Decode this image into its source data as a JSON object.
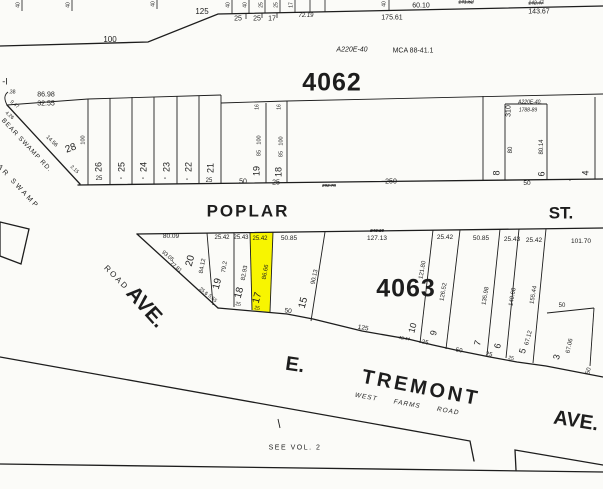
{
  "colors": {
    "paper": "#fbfbf8",
    "ink": "#1d1d1d",
    "highlight": "#f8f500"
  },
  "map": {
    "blocks": [
      "4062",
      "4063"
    ],
    "streets": [
      "POPLAR ST.",
      "E. TREMONT AVE.",
      "WEST FARMS ROAD",
      "BEAR SWAMP RD.",
      "AVE.",
      "ROAD"
    ],
    "notes": [
      "SEE VOL. 2",
      "MCA 88-41.1",
      "A220E-40",
      "A220E-40, 1788-89"
    ],
    "highlighted_lot": {
      "block": "4063",
      "lot": "17",
      "frontage": "25.42",
      "depth": "86.66"
    },
    "labels": [
      {
        "n": "dim-100",
        "t": "100",
        "x": 110,
        "y": 40,
        "s": 8
      },
      {
        "n": "dim-125",
        "t": "125",
        "x": 202,
        "y": 12,
        "s": 8
      },
      {
        "n": "dim-25",
        "t": "25",
        "x": 238,
        "y": 19,
        "s": 7
      },
      {
        "n": "dim-25",
        "t": "25",
        "x": 257,
        "y": 19,
        "s": 7
      },
      {
        "n": "dim-17",
        "t": "17",
        "x": 272,
        "y": 19,
        "s": 7
      },
      {
        "n": "dim-72-19",
        "t": "72.19",
        "x": 306,
        "y": 16,
        "s": 6,
        "i": 1
      },
      {
        "n": "dim-175-61",
        "t": "175.61",
        "x": 392,
        "y": 18,
        "s": 7
      },
      {
        "n": "dim-60-10",
        "t": "60.10",
        "x": 421,
        "y": 6,
        "s": 7
      },
      {
        "n": "dim-141-52",
        "t": "141.52",
        "x": 466,
        "y": 3,
        "s": 5,
        "i": 1,
        "k": 1
      },
      {
        "n": "dim-142-47",
        "t": "142.47",
        "x": 536,
        "y": 4,
        "s": 5,
        "i": 1,
        "k": 1
      },
      {
        "n": "dim-143-67",
        "t": "143.67",
        "x": 539,
        "y": 12,
        "s": 7
      },
      {
        "n": "stub-dim",
        "t": "40",
        "x": 19,
        "y": 5,
        "s": 5,
        "r": -90
      },
      {
        "n": "stub-dim",
        "t": "40",
        "x": 69,
        "y": 5,
        "s": 5,
        "r": -90
      },
      {
        "n": "stub-dim",
        "t": "40",
        "x": 154,
        "y": 4,
        "s": 5,
        "r": -90
      },
      {
        "n": "stub-dim",
        "t": "40",
        "x": 229,
        "y": 5,
        "s": 5,
        "r": -90
      },
      {
        "n": "stub-dim",
        "t": "40",
        "x": 246,
        "y": 5,
        "s": 5,
        "r": -90
      },
      {
        "n": "stub-dim",
        "t": "25",
        "x": 262,
        "y": 5,
        "s": 5,
        "r": -90
      },
      {
        "n": "stub-dim",
        "t": "25",
        "x": 277,
        "y": 5,
        "s": 5,
        "r": -90
      },
      {
        "n": "stub-dim",
        "t": "17",
        "x": 292,
        "y": 5,
        "s": 5,
        "r": -90
      },
      {
        "n": "stub-dim",
        "t": "40",
        "x": 385,
        "y": 4,
        "s": 5,
        "r": -90
      },
      {
        "n": "annotation-a220e",
        "t": "A220E-40",
        "x": 352,
        "y": 50,
        "s": 7,
        "i": 1
      },
      {
        "n": "annotation-mca",
        "t": "MCA 88-41.1",
        "x": 413,
        "y": 51,
        "s": 7
      },
      {
        "n": "block-4062-label",
        "t": "4062",
        "x": 332,
        "y": 83,
        "s": 25,
        "b": 1,
        "sp": 1
      },
      {
        "n": "label-parcel-edge",
        "t": "-I",
        "x": 5,
        "y": 82,
        "s": 9
      },
      {
        "n": "dim-38",
        "t": ".38",
        "x": 12,
        "y": 93,
        "s": 5
      },
      {
        "n": "dim-9-47",
        "t": "9.47",
        "x": 14,
        "y": 105,
        "s": 5,
        "r": 40
      },
      {
        "n": "dim-4-26",
        "t": "4.26",
        "x": 9,
        "y": 116,
        "s": 5,
        "r": 40
      },
      {
        "n": "dim-86-98",
        "t": "86.98",
        "x": 46,
        "y": 95,
        "s": 7
      },
      {
        "n": "dim-32-55",
        "t": "32.55",
        "x": 46,
        "y": 104,
        "s": 7
      },
      {
        "n": "street-bear-swamp-rd",
        "t": "BEAR SWAMP RD.",
        "x": 26,
        "y": 146,
        "s": 6.5,
        "r": 47,
        "sp": 1
      },
      {
        "n": "dim-14-56",
        "t": "14.56",
        "x": 51,
        "y": 142,
        "s": 5.5,
        "r": 44
      },
      {
        "n": "label-ar-swamp",
        "t": "AR SWAMP",
        "x": 18,
        "y": 187,
        "s": 7,
        "r": 47,
        "sp": 2.5
      },
      {
        "n": "lot-28-number",
        "t": "28",
        "x": 71,
        "y": 149,
        "s": 10,
        "r": -20
      },
      {
        "n": "dim-2-15",
        "t": "2.15",
        "x": 74,
        "y": 170,
        "s": 5,
        "r": 44
      },
      {
        "n": "dim-100v",
        "t": "100",
        "x": 84,
        "y": 140,
        "s": 5.5,
        "r": -90
      },
      {
        "n": "lot-26-number",
        "t": "26",
        "x": 99,
        "y": 167,
        "s": 9,
        "r": -90
      },
      {
        "n": "lot-25-number",
        "t": "25",
        "x": 122,
        "y": 167,
        "s": 9,
        "r": -90
      },
      {
        "n": "lot-24-number",
        "t": "24",
        "x": 144,
        "y": 167,
        "s": 9,
        "r": -90
      },
      {
        "n": "lot-23-number",
        "t": "23",
        "x": 167,
        "y": 167,
        "s": 9,
        "r": -90
      },
      {
        "n": "lot-22-number",
        "t": "22",
        "x": 189,
        "y": 167,
        "s": 9,
        "r": -90
      },
      {
        "n": "lot-21-number",
        "t": "21",
        "x": 211,
        "y": 168,
        "s": 9,
        "r": -90
      },
      {
        "n": "dim-frontage",
        "t": "25",
        "x": 99,
        "y": 179,
        "s": 6
      },
      {
        "n": "dim-ditto",
        "t": "\"",
        "x": 121,
        "y": 181,
        "s": 6
      },
      {
        "n": "dim-ditto",
        "t": "\"",
        "x": 143,
        "y": 181,
        "s": 6
      },
      {
        "n": "dim-ditto",
        "t": "\"",
        "x": 165,
        "y": 181,
        "s": 6
      },
      {
        "n": "dim-ditto",
        "t": "\"",
        "x": 187,
        "y": 182,
        "s": 6
      },
      {
        "n": "dim-frontage",
        "t": "25",
        "x": 209,
        "y": 181,
        "s": 6
      },
      {
        "n": "lot-19-number",
        "t": "19",
        "x": 257,
        "y": 171,
        "s": 9,
        "r": -90
      },
      {
        "n": "lot-18-number",
        "t": "18",
        "x": 279,
        "y": 172,
        "s": 9,
        "r": -90
      },
      {
        "n": "dim-frontage",
        "t": "50",
        "x": 243,
        "y": 182,
        "s": 7
      },
      {
        "n": "dim-frontage",
        "t": "25",
        "x": 276,
        "y": 183,
        "s": 7
      },
      {
        "n": "dim-16",
        "t": "16",
        "x": 258,
        "y": 107,
        "s": 5,
        "r": -90
      },
      {
        "n": "dim-16",
        "t": "16",
        "x": 280,
        "y": 107,
        "s": 5,
        "r": -90
      },
      {
        "n": "dim-depth",
        "t": "100",
        "x": 260,
        "y": 140,
        "s": 5.5,
        "r": -90
      },
      {
        "n": "dim-depth",
        "t": "85",
        "x": 260,
        "y": 153,
        "s": 5.5,
        "r": -90
      },
      {
        "n": "dim-depth",
        "t": "100",
        "x": 282,
        "y": 141,
        "s": 5.5,
        "r": -90
      },
      {
        "n": "dim-depth",
        "t": "85",
        "x": 282,
        "y": 154,
        "s": 5.5,
        "r": -90
      },
      {
        "n": "dim-250",
        "t": "250",
        "x": 391,
        "y": 182,
        "s": 7
      },
      {
        "n": "dim-old",
        "t": "292.78",
        "x": 329,
        "y": 186,
        "s": 4.5,
        "i": 1,
        "k": 1
      },
      {
        "n": "lot-8-number",
        "t": "8",
        "x": 497,
        "y": 173,
        "s": 9,
        "r": -90
      },
      {
        "n": "dim-310",
        "t": "310",
        "x": 509,
        "y": 111,
        "s": 7,
        "r": -90
      },
      {
        "n": "annotation-a220e-2",
        "t": "A220E-40,",
        "x": 530,
        "y": 103,
        "s": 5,
        "i": 1
      },
      {
        "n": "annotation-1788",
        "t": "1788-89",
        "x": 528,
        "y": 111,
        "s": 5,
        "i": 1
      },
      {
        "n": "dim-depth",
        "t": "80",
        "x": 511,
        "y": 150,
        "s": 6,
        "r": -90
      },
      {
        "n": "dim-depth",
        "t": "80.14",
        "x": 542,
        "y": 147,
        "s": 6,
        "r": -90
      },
      {
        "n": "lot-6-number",
        "t": "6",
        "x": 542,
        "y": 174,
        "s": 9,
        "r": -90
      },
      {
        "n": "dim-frontage",
        "t": "50",
        "x": 527,
        "y": 184,
        "s": 6.5
      },
      {
        "n": "lot-4-number",
        "t": "4",
        "x": 586,
        "y": 173,
        "s": 9,
        "r": -90
      },
      {
        "n": "center-dot",
        "t": "·",
        "x": 570,
        "y": 181,
        "s": 8
      },
      {
        "n": "street-label-poplar",
        "t": "POPLAR",
        "x": 248,
        "y": 211,
        "s": 17,
        "b": 1,
        "sp": 2
      },
      {
        "n": "street-label-st",
        "t": "ST.",
        "x": 561,
        "y": 213,
        "s": 17,
        "b": 1
      },
      {
        "n": "dim-80-09",
        "t": "80.09",
        "x": 171,
        "y": 237,
        "s": 6.5
      },
      {
        "n": "dim",
        "t": "25.42",
        "x": 222,
        "y": 238,
        "s": 6
      },
      {
        "n": "dim",
        "t": "25.43",
        "x": 241,
        "y": 238,
        "s": 6
      },
      {
        "n": "dim-lot17",
        "t": "25.42",
        "x": 260,
        "y": 239,
        "s": 6
      },
      {
        "n": "dim",
        "t": "50.85",
        "x": 289,
        "y": 239,
        "s": 6.5
      },
      {
        "n": "dim-old",
        "t": "243.18",
        "x": 377,
        "y": 231,
        "s": 4.5,
        "i": 1,
        "k": 1
      },
      {
        "n": "dim-127-13",
        "t": "127.13",
        "x": 377,
        "y": 239,
        "s": 6.5
      },
      {
        "n": "dim",
        "t": "25.42",
        "x": 445,
        "y": 238,
        "s": 6.5
      },
      {
        "n": "dim",
        "t": "50.85",
        "x": 481,
        "y": 239,
        "s": 6.5
      },
      {
        "n": "dim",
        "t": "25.43",
        "x": 512,
        "y": 240,
        "s": 6.5
      },
      {
        "n": "dim",
        "t": "25.42",
        "x": 534,
        "y": 241,
        "s": 6.5
      },
      {
        "n": "dim-101-70",
        "t": "101.70",
        "x": 581,
        "y": 242,
        "s": 6.5
      },
      {
        "n": "block-4063-label",
        "t": "4063",
        "x": 406,
        "y": 289,
        "s": 25,
        "b": 1,
        "sp": 1
      },
      {
        "n": "lot-20-number",
        "t": "20",
        "x": 191,
        "y": 261,
        "s": 10,
        "r": -75
      },
      {
        "n": "dim-depth",
        "t": "84.12",
        "x": 203,
        "y": 266,
        "s": 6,
        "r": -80
      },
      {
        "n": "dim-93-05",
        "t": "93.05",
        "x": 167,
        "y": 257,
        "s": 5.5,
        "r": 40
      },
      {
        "n": "dim-77-81",
        "t": "77.81",
        "x": 175,
        "y": 268,
        "s": 5.5,
        "r": 40
      },
      {
        "n": "lot-19b-number",
        "t": "19",
        "x": 218,
        "y": 284,
        "s": 10,
        "r": -75
      },
      {
        "n": "dim-depth",
        "t": "79.2",
        "x": 225,
        "y": 267,
        "s": 6,
        "r": -80
      },
      {
        "n": "lot-18b-number",
        "t": "18",
        "x": 240,
        "y": 293,
        "s": 10,
        "r": -75
      },
      {
        "n": "dim-depth",
        "t": "82.93",
        "x": 245,
        "y": 273,
        "s": 6,
        "r": -80
      },
      {
        "n": "lot-17-number",
        "t": "17",
        "x": 258,
        "y": 298,
        "s": 10,
        "r": -75
      },
      {
        "n": "dim-depth-lot17",
        "t": "86.66",
        "x": 266,
        "y": 272,
        "s": 6,
        "r": -80
      },
      {
        "n": "lot-15-number",
        "t": "15",
        "x": 304,
        "y": 303,
        "s": 10,
        "r": -75
      },
      {
        "n": "dim-depth",
        "t": "90.13",
        "x": 315,
        "y": 277,
        "s": 6,
        "r": -78
      },
      {
        "n": "dim-25-6",
        "t": "25.6",
        "x": 203,
        "y": 292,
        "s": 5,
        "r": 40
      },
      {
        "n": "dim-5-55",
        "t": "5.55",
        "x": 212,
        "y": 299,
        "s": 5,
        "r": 40
      },
      {
        "n": "dim-frontage",
        "t": "25",
        "x": 238,
        "y": 305,
        "s": 5,
        "r": 10
      },
      {
        "n": "dim-frontage",
        "t": "25",
        "x": 257,
        "y": 309,
        "s": 5,
        "r": 10
      },
      {
        "n": "dim-frontage",
        "t": "50",
        "x": 288,
        "y": 312,
        "s": 6.5,
        "r": 8
      },
      {
        "n": "dim-frontage",
        "t": "125",
        "x": 363,
        "y": 329,
        "s": 6.5,
        "r": 10
      },
      {
        "n": "dim-old",
        "t": "43.44",
        "x": 404,
        "y": 339,
        "s": 4.5,
        "i": 1,
        "k": 1,
        "r": 10
      },
      {
        "n": "dim-depth",
        "t": "121.80",
        "x": 423,
        "y": 270,
        "s": 6,
        "r": -80
      },
      {
        "n": "lot-10-number",
        "t": "10",
        "x": 413,
        "y": 328,
        "s": 9,
        "r": -75
      },
      {
        "n": "dim-frontage",
        "t": "25",
        "x": 425,
        "y": 343,
        "s": 6,
        "r": 10
      },
      {
        "n": "lot-9-number",
        "t": "9",
        "x": 434,
        "y": 333,
        "s": 9,
        "r": -75
      },
      {
        "n": "dim-depth",
        "t": "126.52",
        "x": 444,
        "y": 292,
        "s": 6,
        "r": -80
      },
      {
        "n": "dim-frontage",
        "t": "50",
        "x": 459,
        "y": 351,
        "s": 6,
        "r": 10
      },
      {
        "n": "lot-7-number",
        "t": "7",
        "x": 478,
        "y": 343,
        "s": 9,
        "r": -75
      },
      {
        "n": "dim-depth",
        "t": "135.98",
        "x": 486,
        "y": 296,
        "s": 6,
        "r": -80
      },
      {
        "n": "dim-frontage",
        "t": "25",
        "x": 489,
        "y": 355,
        "s": 6,
        "r": 10
      },
      {
        "n": "lot-6b-number",
        "t": "6",
        "x": 498,
        "y": 346,
        "s": 9,
        "r": -75
      },
      {
        "n": "dim-depth",
        "t": "140.68",
        "x": 513,
        "y": 297,
        "s": 6,
        "r": -80
      },
      {
        "n": "lot-5-number",
        "t": "5",
        "x": 523,
        "y": 351,
        "s": 9,
        "r": -75
      },
      {
        "n": "dim-frontage",
        "t": "25",
        "x": 511,
        "y": 359,
        "s": 5,
        "r": 10
      },
      {
        "n": "dim-depth",
        "t": "155.44",
        "x": 534,
        "y": 295,
        "s": 6,
        "r": -80
      },
      {
        "n": "dim-67-12",
        "t": "67.12",
        "x": 529,
        "y": 338,
        "s": 6,
        "r": -75
      },
      {
        "n": "dim-50-inner",
        "t": "50",
        "x": 562,
        "y": 306,
        "s": 6
      },
      {
        "n": "lot-3-number",
        "t": "3",
        "x": 557,
        "y": 357,
        "s": 9,
        "r": -75
      },
      {
        "n": "dim-67-06",
        "t": "67.06",
        "x": 570,
        "y": 346,
        "s": 6,
        "r": -78
      },
      {
        "n": "dim-frontage",
        "t": "50",
        "x": 589,
        "y": 371,
        "s": 6,
        "r": -75
      },
      {
        "n": "street-label-road",
        "t": "ROAD",
        "x": 116,
        "y": 278,
        "s": 8,
        "r": 45,
        "sp": 2
      },
      {
        "n": "street-label-ave-west",
        "t": "AVE.",
        "x": 146,
        "y": 307,
        "s": 21,
        "b": 1,
        "r": 48
      },
      {
        "n": "street-label-e",
        "t": "E.",
        "x": 295,
        "y": 365,
        "s": 20,
        "b": 1,
        "r": 8
      },
      {
        "n": "street-label-tremont",
        "t": "TREMONT",
        "x": 421,
        "y": 388,
        "s": 20,
        "b": 1,
        "r": 11,
        "sp": 3
      },
      {
        "n": "street-label-ave-east",
        "t": "AVE.",
        "x": 576,
        "y": 421,
        "s": 20,
        "b": 1,
        "r": 9
      },
      {
        "n": "street-label-west",
        "t": "WEST",
        "x": 366,
        "y": 398,
        "s": 6.5,
        "i": 1,
        "r": 10,
        "sp": 1
      },
      {
        "n": "street-label-farms",
        "t": "FARMS",
        "x": 407,
        "y": 405,
        "s": 6.5,
        "i": 1,
        "r": 10,
        "sp": 1
      },
      {
        "n": "street-label-road-2",
        "t": "ROAD",
        "x": 448,
        "y": 412,
        "s": 6.5,
        "i": 1,
        "r": 10,
        "sp": 1
      },
      {
        "n": "note-see-vol-2",
        "t": "SEE VOL. 2",
        "x": 295,
        "y": 448,
        "s": 7,
        "sp": 1.5
      }
    ]
  }
}
